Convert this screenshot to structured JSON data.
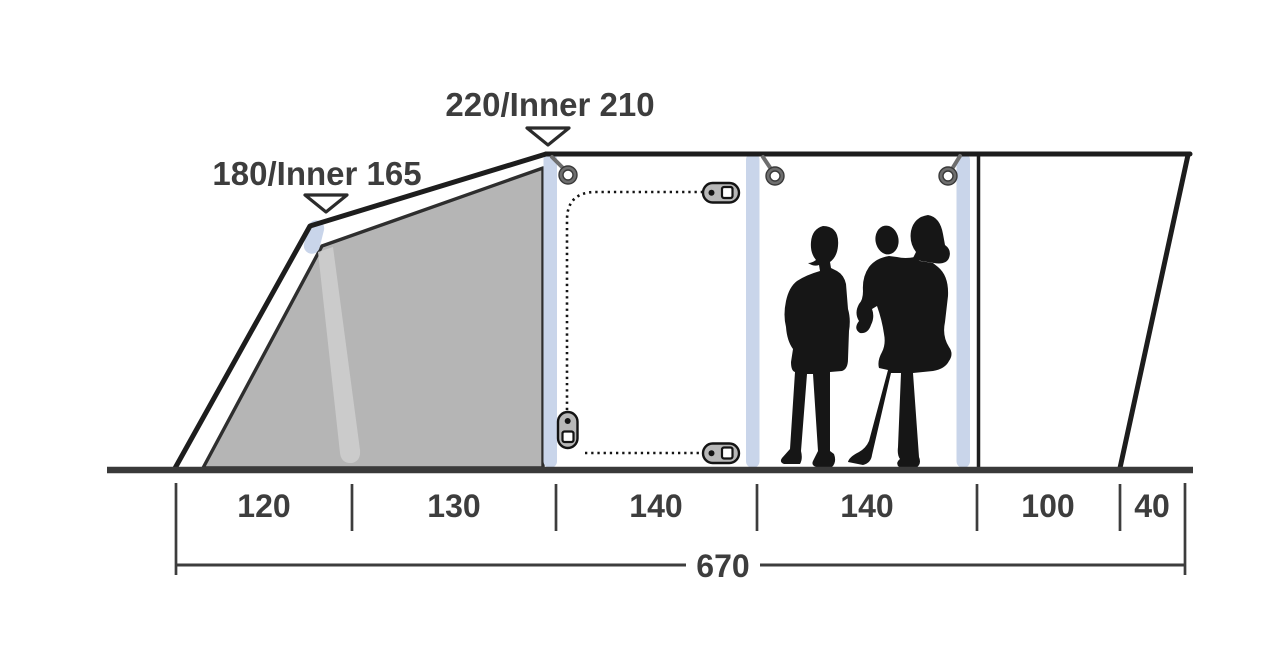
{
  "diagram": {
    "subject": "tent-side-profile-dimensions",
    "height_labels": {
      "front": "180/Inner 165",
      "peak": "220/Inner 210"
    },
    "floor_dimensions": [
      "120",
      "130",
      "140",
      "140",
      "100",
      "40"
    ],
    "total_length": "670",
    "colors": {
      "outline": "#1d1d1d",
      "ground": "#3a3a3a",
      "dimension_text": "#3d3d3d",
      "fabric_panel": "#b5b5b5",
      "panel_highlight": "#cdcdcd",
      "air_pole": "#c9d5ea",
      "figure_silhouette": "#161616",
      "zipper_pull": "#b8b8b8",
      "ring": "#6e6e6e",
      "background": "#ffffff"
    }
  }
}
